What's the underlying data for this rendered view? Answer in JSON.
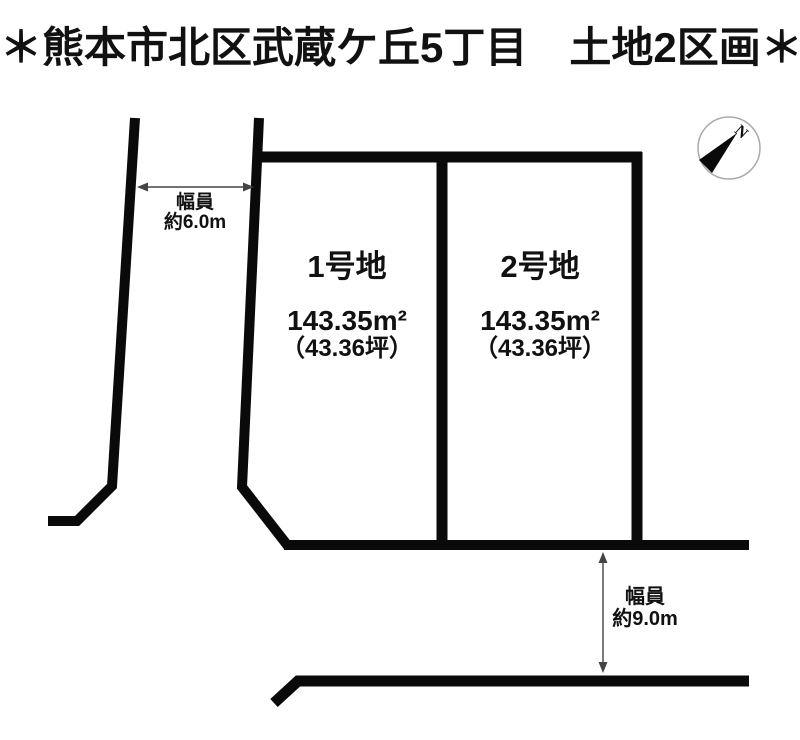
{
  "page": {
    "title": "＊熊本市北区武蔵ケ丘5丁目　土地2区画＊"
  },
  "compass": {
    "north_label": "N"
  },
  "roads": {
    "left": {
      "width_caption": "幅員",
      "width_value": "約6.0m"
    },
    "bottom": {
      "width_caption": "幅員",
      "width_value": "約9.0m"
    }
  },
  "plots": [
    {
      "name": "1号地",
      "area_sqm": "143.35m²",
      "area_tsubo": "（43.36坪）"
    },
    {
      "name": "2号地",
      "area_sqm": "143.35m²",
      "area_tsubo": "（43.36坪）"
    }
  ],
  "colors": {
    "boundary_line": "#0a0a0a",
    "dimension_arrow": "#444444",
    "compass_ring": "#aaaaaa",
    "text": "#111111",
    "background": "#ffffff"
  }
}
